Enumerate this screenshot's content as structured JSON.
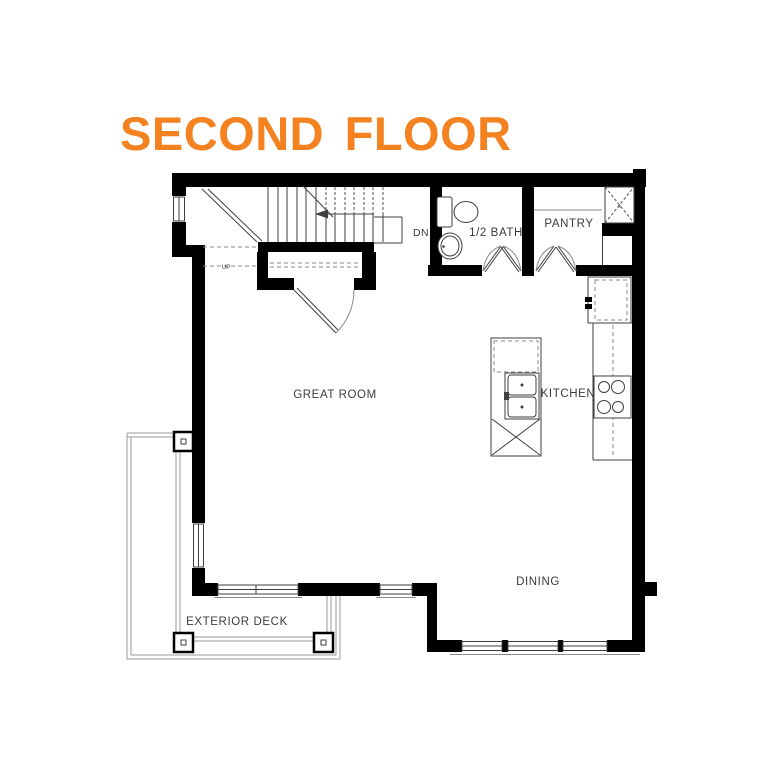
{
  "title": {
    "text": "SECOND FLOOR",
    "color": "#F58220"
  },
  "plan": {
    "labels": {
      "great_room": "GREAT ROOM",
      "kitchen": "KITCHEN",
      "dining": "DINING",
      "half_bath": "1/2 BATH",
      "pantry": "PANTRY",
      "exterior_deck": "EXTERIOR DECK",
      "stairs_down": "DN",
      "stairs_up": "UP",
      "chase_mark": "x"
    },
    "features": [
      "staircase-with-winders",
      "under-stair-closet",
      "toilet",
      "vanity-sink",
      "double-doors-bath",
      "double-doors-pantry",
      "mechanical-chase-x",
      "refrigerator",
      "cooktop-4-burner",
      "kitchen-island-double-sink",
      "dishwasher-x",
      "deck-posts",
      "windows"
    ]
  },
  "colors": {
    "accent": "#F58220",
    "wall": "#000000",
    "thin_line": "#3f3f3f",
    "dashed_line": "#8a8a8a",
    "label_text": "#3b3b3b",
    "background": "#ffffff"
  }
}
